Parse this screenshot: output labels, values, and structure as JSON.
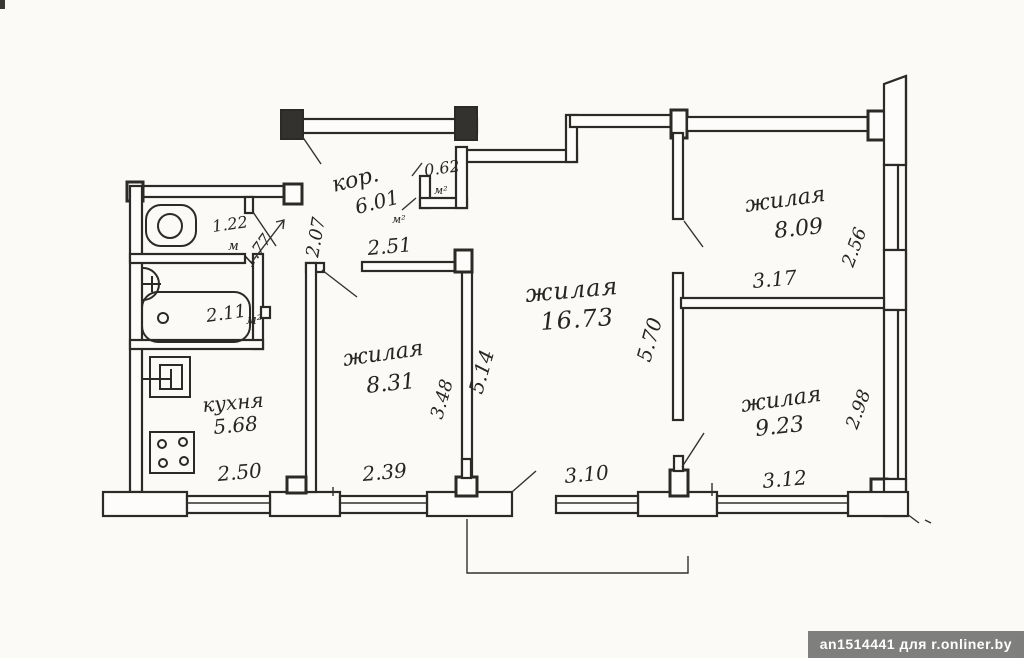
{
  "plan": {
    "rooms": [
      {
        "id": "toilet",
        "name": "",
        "area": "1.22",
        "unit": "м"
      },
      {
        "id": "bathroom",
        "name": "",
        "area": "2.11",
        "unit": "м²"
      },
      {
        "id": "corridor",
        "name": "кор.",
        "area": "6.01",
        "unit": "м²"
      },
      {
        "id": "closet",
        "name": "",
        "area": "0.62",
        "unit": "м²"
      },
      {
        "id": "kitchen",
        "name": "кухня",
        "area": "5.68",
        "unit": ""
      },
      {
        "id": "living-small",
        "name": "жилая",
        "area": "8.31",
        "unit": ""
      },
      {
        "id": "living-large",
        "name": "жилая",
        "area": "16.73",
        "unit": ""
      },
      {
        "id": "living-top-right",
        "name": "жилая",
        "area": "8.09",
        "unit": ""
      },
      {
        "id": "living-bot-right",
        "name": "жилая",
        "area": "9.23",
        "unit": ""
      }
    ],
    "dimensions": {
      "d2_07": "2.07",
      "d1_77": "1.77",
      "d2_51": "2.51",
      "d2_50": "2.50",
      "d2_39": "2.39",
      "d3_48": "3.48",
      "d5_14": "5.14",
      "d3_10": "3.10",
      "d5_70": "5.70",
      "d3_17": "3.17",
      "d2_56": "2.56",
      "d3_12": "3.12",
      "d2_98": "2.98"
    }
  },
  "watermark": {
    "text": "an1514441 для r.onliner.by"
  },
  "colors": {
    "ink": "#2b2a27",
    "paper": "#fbfaf7",
    "watermark_bg": "#686868",
    "watermark_text": "#ffffff"
  }
}
